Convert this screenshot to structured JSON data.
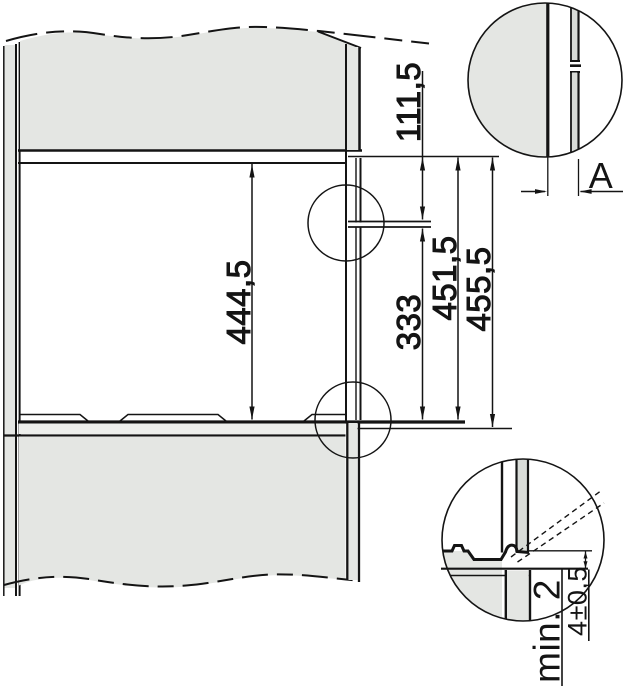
{
  "dimensions": {
    "niche_height": "444,5",
    "top_clearance": "111,5",
    "bracket_to_bottom": "333",
    "inner_depth": "451,5",
    "outer_depth": "455,5"
  },
  "details": {
    "gap_label": "A",
    "front_gap": "min. 2",
    "bottom_gap_tolerance": "4±0,5"
  },
  "colors": {
    "panel_gray": "#e4e6e3",
    "strip_gray": "#d9dcd8",
    "light_strip_gray": "#edefec",
    "line_black": "#141414",
    "background": "#ffffff"
  }
}
